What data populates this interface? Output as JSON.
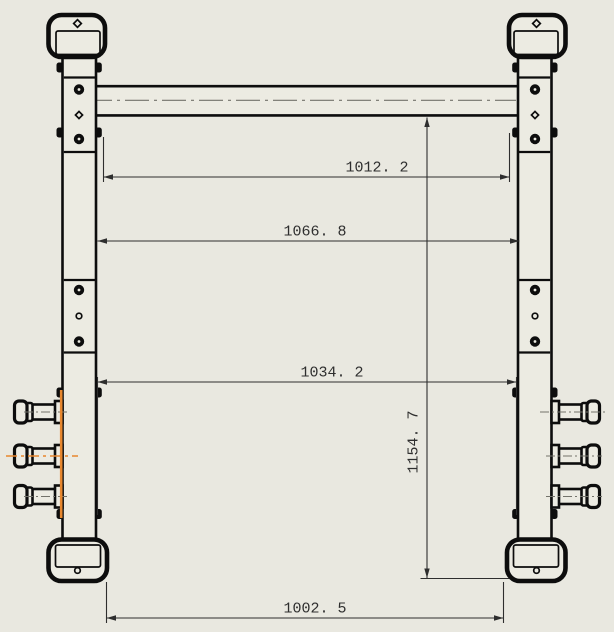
{
  "drawing": {
    "kind": "cad-orthographic-drawing",
    "subject": "rack-frame-front-view"
  },
  "colors": {
    "bg": "#e9e8e0",
    "fill": "#ecebe2",
    "line": "#0d0d0d",
    "dim": "#2e2e2e",
    "center": "#73736b",
    "accent": "#e8872e"
  },
  "dimensions": {
    "d1012": {
      "label": "1012. 2",
      "value": 1012.2
    },
    "d1066": {
      "label": "1066. 8",
      "value": 1066.8
    },
    "d1034": {
      "label": "1034. 2",
      "value": 1034.2
    },
    "d1154": {
      "label": "1154. 7",
      "value": 1154.7
    },
    "d1002": {
      "label": "1002. 5",
      "value": 1002.5
    }
  }
}
